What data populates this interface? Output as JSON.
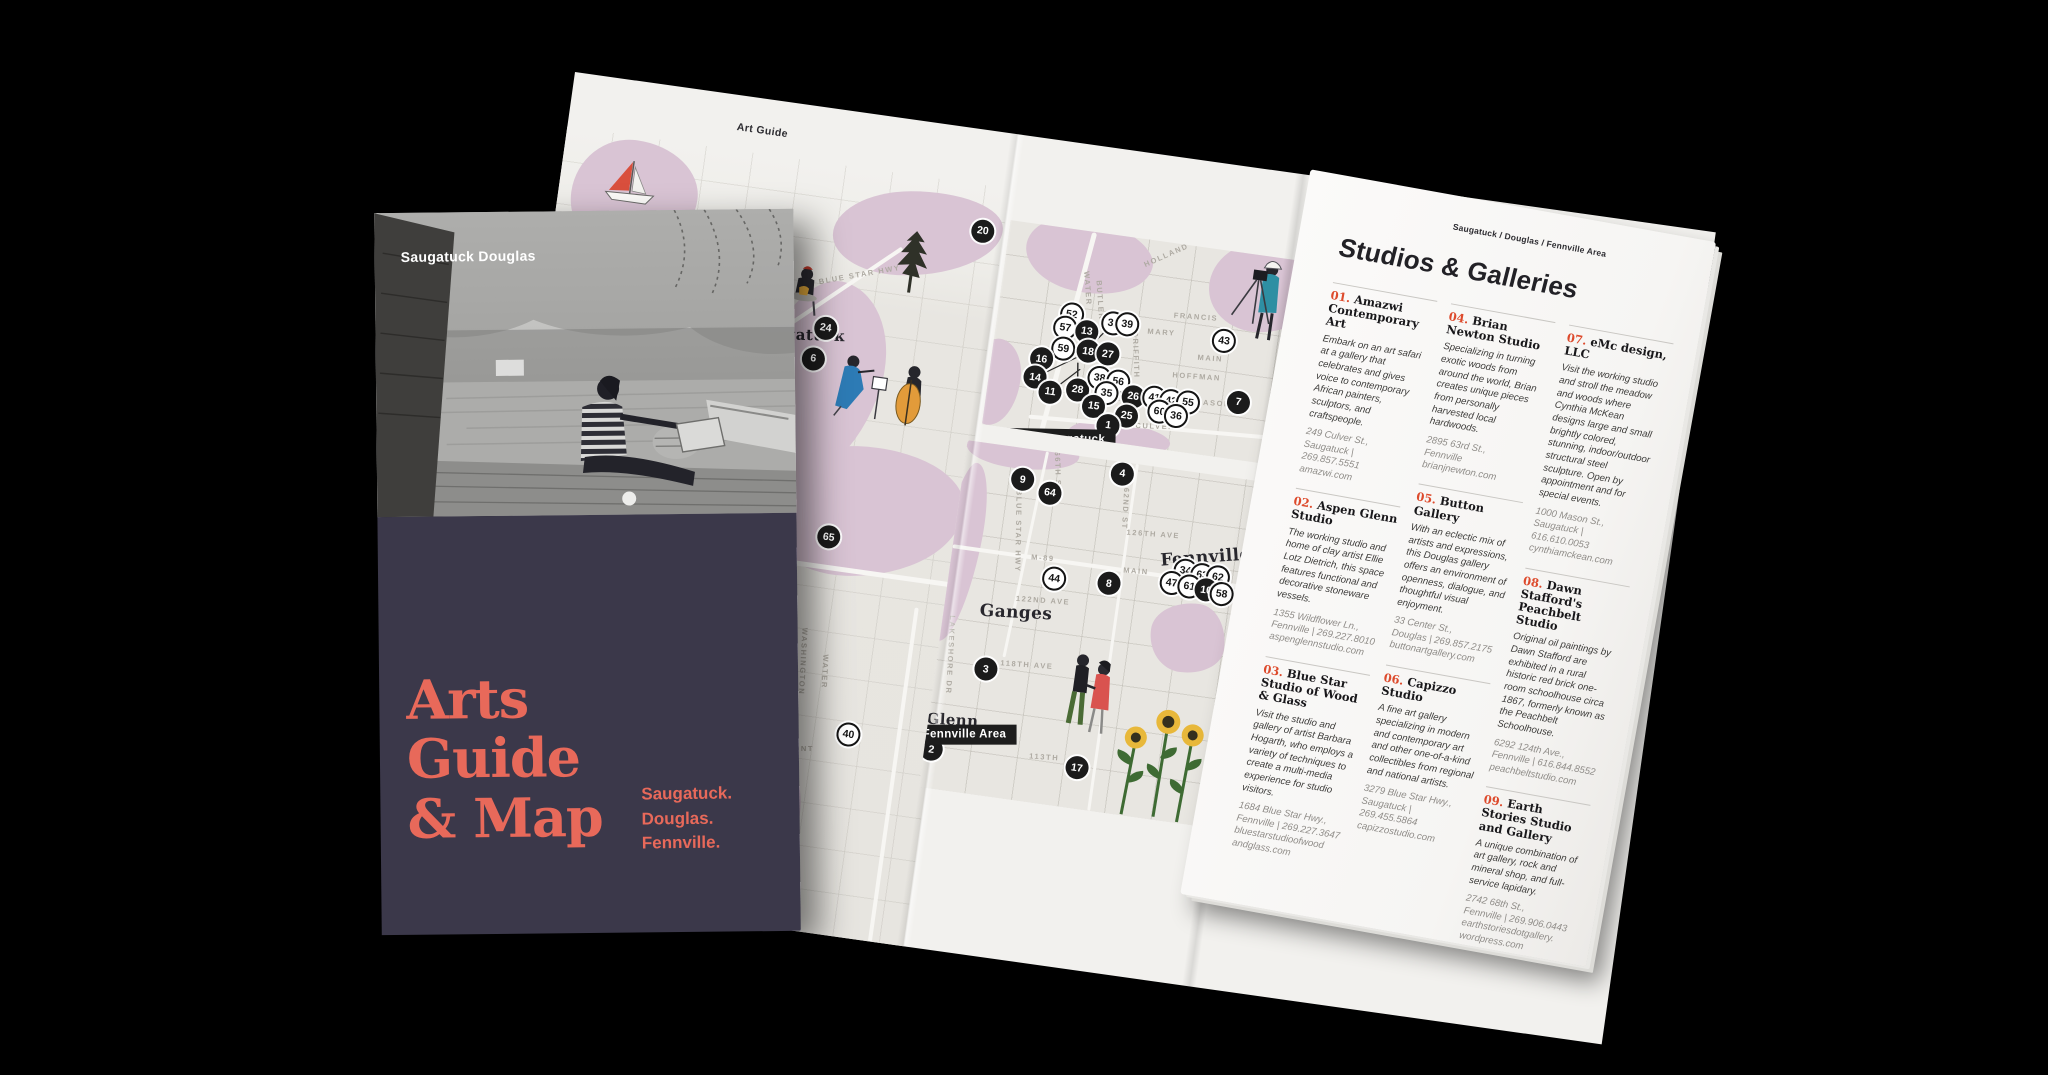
{
  "colors": {
    "coral": "#e8695a",
    "navy": "#3b384a",
    "red_number": "#dd4a2c",
    "paper": "#f2f1ee",
    "map_land": "#e8e6e1",
    "water_pink": "#d9c4d4",
    "tag_black": "#1d1d1d"
  },
  "cover": {
    "photo_label": "Saugatuck Douglas",
    "title": "Arts\nGuide\n& Map",
    "subtitle": "Saugatuck.\nDouglas.\nFennville."
  },
  "spread": {
    "left_header": "Art Guide",
    "right_header": "Saugatuck / Douglas / Fennville Area",
    "title": "Studios & Galleries"
  },
  "maps": {
    "left": {
      "illustrations": [
        "sailboat-icon",
        "potter-icon",
        "string-trio-icon",
        "pine-tree-icon"
      ],
      "places": [
        {
          "t": "Saugatuck",
          "x": 57.7,
          "y": 22.7,
          "r": -6,
          "s": 15
        }
      ],
      "streets": [
        {
          "t": "BLUE STAR HWY",
          "x": 69.4,
          "y": 13.9,
          "r": -18
        },
        {
          "t": "WASHINGTON",
          "x": 68.9,
          "y": 65.0,
          "r": 85
        },
        {
          "t": "WATER",
          "x": 74.0,
          "y": 65.9,
          "r": 85
        },
        {
          "t": "FREMONT",
          "x": 68.7,
          "y": 76.5,
          "r": -8
        }
      ],
      "markers": [
        {
          "n": "20",
          "k": "b",
          "x": 95.3,
          "y": 6.0
        },
        {
          "n": "24",
          "k": "b",
          "x": 63.5,
          "y": 21.4
        },
        {
          "n": "6",
          "k": "b",
          "x": 61.7,
          "y": 25.6
        },
        {
          "n": "65",
          "k": "b",
          "x": 70.7,
          "y": 48.4
        },
        {
          "n": "40",
          "k": "w",
          "x": 81.2,
          "y": 73.6
        }
      ]
    },
    "downtown": {
      "label": "Downtown Saugatuck",
      "illustrations": [
        "photographer-icon"
      ],
      "places": [],
      "streets": [
        {
          "t": "HOLLAND",
          "x": 49.7,
          "y": 6.5,
          "r": -32
        },
        {
          "t": "WATER",
          "x": 26.9,
          "y": 27.5,
          "r": 78
        },
        {
          "t": "BUTLER",
          "x": 31.3,
          "y": 32.4,
          "r": 78
        },
        {
          "t": "FRANCIS",
          "x": 61.6,
          "y": 33.8,
          "r": -4
        },
        {
          "t": "MARY",
          "x": 51.6,
          "y": 43.6,
          "r": -4
        },
        {
          "t": "MAIN",
          "x": 67.8,
          "y": 52.9,
          "r": -4
        },
        {
          "t": "GRIFFITH",
          "x": 44.7,
          "y": 56.4,
          "r": 80
        },
        {
          "t": "HOFFMAN",
          "x": 64.4,
          "y": 62.7,
          "r": -4
        },
        {
          "t": "MASON",
          "x": 70.6,
          "y": 74.5,
          "r": -4
        },
        {
          "t": "CULVER",
          "x": 53.8,
          "y": 89.2,
          "r": -6
        }
      ],
      "markers": [
        {
          "n": "52",
          "k": "w",
          "x": 23.0,
          "y": 41.2
        },
        {
          "n": "57",
          "k": "w",
          "x": 21.6,
          "y": 48.0
        },
        {
          "n": "13",
          "k": "b",
          "x": 28.4,
          "y": 48.5
        },
        {
          "n": "59",
          "k": "w",
          "x": 21.9,
          "y": 58.3
        },
        {
          "n": "18",
          "k": "b",
          "x": 29.7,
          "y": 57.8
        },
        {
          "n": "32",
          "k": "w",
          "x": 36.3,
          "y": 42.6
        },
        {
          "n": "39",
          "k": "w",
          "x": 40.6,
          "y": 42.2
        },
        {
          "n": "27",
          "k": "b",
          "x": 35.9,
          "y": 57.8
        },
        {
          "n": "43",
          "k": "w",
          "x": 71.3,
          "y": 43.6
        },
        {
          "n": "16",
          "k": "b",
          "x": 15.6,
          "y": 64.7
        },
        {
          "n": "14",
          "k": "b",
          "x": 14.4,
          "y": 74.0
        },
        {
          "n": "11",
          "k": "b",
          "x": 19.7,
          "y": 79.9
        },
        {
          "n": "28",
          "k": "b",
          "x": 28.1,
          "y": 77.0
        },
        {
          "n": "38",
          "k": "w",
          "x": 34.4,
          "y": 70.1
        },
        {
          "n": "56",
          "k": "w",
          "x": 40.3,
          "y": 70.6
        },
        {
          "n": "35",
          "k": "w",
          "x": 37.2,
          "y": 76.5
        },
        {
          "n": "15",
          "k": "b",
          "x": 33.8,
          "y": 83.8
        },
        {
          "n": "26",
          "k": "b",
          "x": 45.6,
          "y": 76.5
        },
        {
          "n": "25",
          "k": "b",
          "x": 44.4,
          "y": 86.3
        },
        {
          "n": "1",
          "k": "b",
          "x": 39.1,
          "y": 92.2
        },
        {
          "n": "41",
          "k": "w",
          "x": 52.2,
          "y": 75.5
        },
        {
          "n": "42",
          "k": "w",
          "x": 57.5,
          "y": 76.0
        },
        {
          "n": "55",
          "k": "w",
          "x": 62.8,
          "y": 75.5
        },
        {
          "n": "60",
          "k": "w",
          "x": 54.4,
          "y": 81.9
        },
        {
          "n": "36",
          "k": "w",
          "x": 59.7,
          "y": 82.8
        },
        {
          "n": "7",
          "k": "b",
          "x": 78.4,
          "y": 72.1
        }
      ]
    },
    "fennville": {
      "label": "Fennville Area",
      "illustrations": [
        "walking-couple-icon",
        "sunflowers-icon"
      ],
      "places": [
        {
          "t": "Fennville",
          "x": 66.7,
          "y": 23.7,
          "r": -12,
          "s": 17
        },
        {
          "t": "Ganges",
          "x": 19.0,
          "y": 46.9,
          "r": -5,
          "s": 17
        },
        {
          "t": "Glenn",
          "x": 6.3,
          "y": 79.7,
          "r": -5,
          "s": 15
        }
      ],
      "streets": [
        {
          "t": "66TH ST",
          "x": 24.9,
          "y": 5.4,
          "r": 80
        },
        {
          "t": "62ND ST",
          "x": 43.9,
          "y": 13.2,
          "r": 85
        },
        {
          "t": "BLUE STAR HWY",
          "x": 16.7,
          "y": 23.7,
          "r": 83
        },
        {
          "t": "126TH AVE",
          "x": 52.1,
          "y": 19.1,
          "r": -4
        },
        {
          "t": "M-89",
          "x": 24.1,
          "y": 30.3,
          "r": -4
        },
        {
          "t": "MAIN",
          "x": 48.9,
          "y": 30.3,
          "r": -4
        },
        {
          "t": "122ND AVE",
          "x": 25.7,
          "y": 42.3,
          "r": -4
        },
        {
          "t": "118TH AVE",
          "x": 23.8,
          "y": 61.1,
          "r": -4
        },
        {
          "t": "LAKESHORE DR",
          "x": 3.4,
          "y": 61.4,
          "r": 85
        },
        {
          "t": "113TH",
          "x": 31.7,
          "y": 86.6,
          "r": -4
        }
      ],
      "markers": [
        {
          "n": "9",
          "k": "b",
          "x": 15.9,
          "y": 8.9
        },
        {
          "n": "64",
          "k": "b",
          "x": 23.5,
          "y": 11.7
        },
        {
          "n": "4",
          "k": "b",
          "x": 41.8,
          "y": 3.4
        },
        {
          "n": "44",
          "k": "w",
          "x": 27.8,
          "y": 35.7
        },
        {
          "n": "8",
          "k": "b",
          "x": 42.3,
          "y": 34.9
        },
        {
          "n": "34",
          "k": "w",
          "x": 61.9,
          "y": 28.3
        },
        {
          "n": "63",
          "k": "w",
          "x": 66.4,
          "y": 28.9
        },
        {
          "n": "62",
          "k": "w",
          "x": 70.6,
          "y": 28.9
        },
        {
          "n": "47",
          "k": "w",
          "x": 58.7,
          "y": 32.3
        },
        {
          "n": "61",
          "k": "w",
          "x": 63.5,
          "y": 32.6
        },
        {
          "n": "10",
          "k": "b",
          "x": 68.0,
          "y": 32.9
        },
        {
          "n": "58",
          "k": "w",
          "x": 72.2,
          "y": 33.4
        },
        {
          "n": "3",
          "k": "b",
          "x": 13.2,
          "y": 64.0
        },
        {
          "n": "2",
          "k": "b",
          "x": 1.9,
          "y": 88.9
        },
        {
          "n": "17",
          "k": "b",
          "x": 40.7,
          "y": 88.3
        }
      ]
    }
  },
  "listings": {
    "columns": [
      [
        {
          "num": "01.",
          "name": "Amazwi Contemporary Art",
          "desc": "Embark on an art safari at a gallery that celebrates and gives voice to contemporary African painters, sculptors, and craftspeople.",
          "addr": [
            "249 Culver St.,",
            "Saugatuck | 269.857.5551",
            "amazwi.com"
          ]
        },
        {
          "num": "02.",
          "name": "Aspen Glenn Studio",
          "desc": "The working studio and home of clay artist Ellie Lotz Dietrich, this space features functional and decorative stoneware vessels.",
          "addr": [
            "1355 Wildflower Ln.,",
            "Fennville | 269.227.8010",
            "aspenglennstudio.com"
          ]
        },
        {
          "num": "03.",
          "name": "Blue Star Studio of Wood & Glass",
          "desc": "Visit the studio and gallery of artist Barbara Hogarth, who employs a variety of techniques to create a multi-media experience for studio visitors.",
          "addr": [
            "1684 Blue Star Hwy.,",
            "Fennville | 269.227.3647",
            "bluestarstudioofwood",
            "andglass.com"
          ]
        }
      ],
      [
        {
          "num": "04.",
          "name": "Brian Newton Studio",
          "desc": "Specializing in turning exotic woods from around the world, Brian creates unique pieces from personally harvested local hardwoods.",
          "addr": [
            "2895 63rd St.,",
            "Fennville",
            "brianjnewton.com"
          ]
        },
        {
          "num": "05.",
          "name": "Button Gallery",
          "desc": "With an eclectic mix of artists and expressions, this Douglas gallery offers an environment of openness, dialogue, and thoughtful visual enjoyment.",
          "addr": [
            "33 Center St.,",
            "Douglas | 269.857.2175",
            "buttonartgallery.com"
          ]
        },
        {
          "num": "06.",
          "name": "Capizzo Studio",
          "desc": "A fine art gallery specializing in modern and contemporary art and other one-of-a-kind collectibles from regional and national artists.",
          "addr": [
            "3279 Blue Star Hwy.,",
            "Saugatuck | 269.455.5864",
            "capizzostudio.com"
          ]
        }
      ],
      [
        {
          "num": "07.",
          "name": "eMc design, LLC",
          "desc": "Visit the working studio and stroll the meadow and woods where Cynthia McKean designs large and small brightly colored, stunning, indoor/outdoor structural steel sculpture. Open by appointment and for special events.",
          "addr": [
            "1000 Mason St.,",
            "Saugatuck | 616.610.0053",
            "cynthiamckean.com"
          ]
        },
        {
          "num": "08.",
          "name": "Dawn Stafford's Peachbelt Studio",
          "desc": "Original oil paintings by Dawn Stafford are exhibited in a rural historic red brick one-room schoolhouse circa 1867, formerly known as the Peachbelt Schoolhouse.",
          "addr": [
            "6292 124th Ave.,",
            "Fennville | 616.844.8552",
            "peachbeltstudio.com"
          ]
        },
        {
          "num": "09.",
          "name": "Earth Stories Studio and Gallery",
          "desc": "A unique combination of art gallery, rock and mineral shop, and full-service lapidary.",
          "addr": [
            "2742 68th St.,",
            "Fennville | 269.906.0443",
            "earthstoriesdotgallery.",
            "wordpress.com"
          ]
        }
      ]
    ]
  }
}
